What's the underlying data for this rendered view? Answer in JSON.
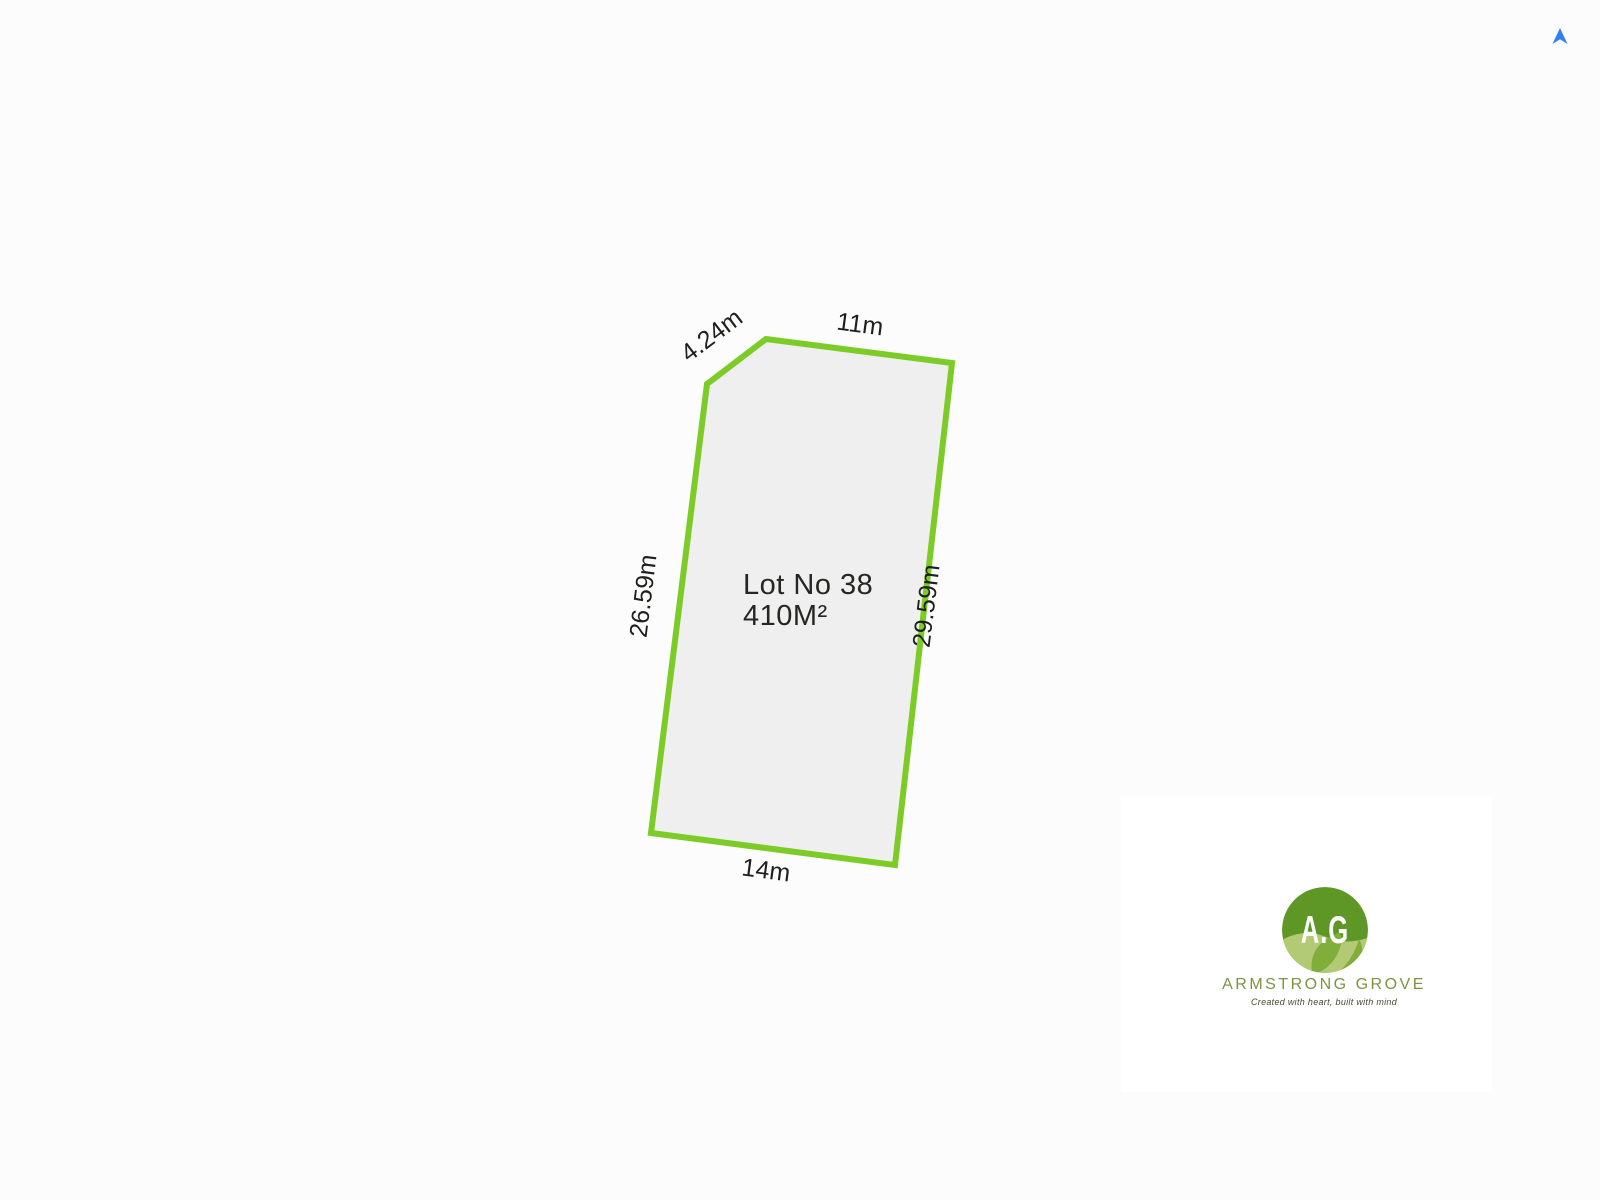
{
  "plan": {
    "lot_label_line1": "Lot No 38",
    "lot_label_line2": "410M²",
    "dimensions": {
      "top_cut": "4.24m",
      "top": "11m",
      "left": "26.59m",
      "right": "29.59m",
      "bottom": "14m"
    },
    "outline_color": "#7ccb27",
    "fill_color": "#efefef",
    "text_color": "#1f1f1d"
  },
  "north_arrow": {
    "color": "#2e7ef5"
  },
  "logo": {
    "monogram": "A.G",
    "company": "ARMSTRONG GROVE",
    "tagline": "Created with heart, built with mind",
    "circle_color": "#5e9726",
    "leaf_light_color": "#b2ca74",
    "leaf_mid_color": "#7fae3a",
    "company_color": "#7e9340"
  }
}
